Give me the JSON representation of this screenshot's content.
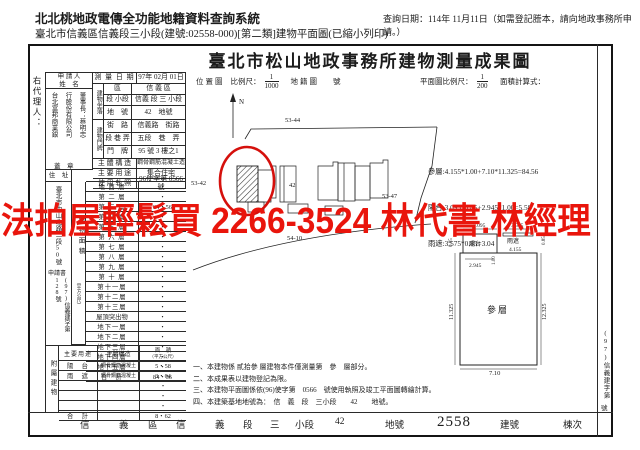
{
  "header": {
    "system_title": "北北桃地政電傳全功能地籍資料查詢系統",
    "query_date": "查詢日期：114年 11月11日（如需登記謄本，請向地政事務所申請。）",
    "doc_line": "臺北市信義區信義段三小段(建號:02558-000)[第二類]建物平面圖(已縮小列印)"
  },
  "title": "臺北市松山地政事務所建物測量成果圖",
  "watermark": "法拍屋輕鬆買 2266-3524 林代書.林經理",
  "margins": {
    "left_agent": "右代理人：",
    "right_doc_no_top": "(97)信義建字第",
    "right_doc_no_bottom": "號"
  },
  "applicant": {
    "label_line1": "申 請 人",
    "label_line2": "姓　名",
    "name_col1": "台北富邦商業銀",
    "name_col2": "行股份有限公司",
    "name_col3": "董事長：蔡明忠",
    "seal": "蓋　章",
    "survey_date_label": "測 量 日 期",
    "survey_date": "97年 02月 01日"
  },
  "situs": {
    "block_label": "建物坐落",
    "rows": [
      {
        "label": "區",
        "value": "信 義 區"
      },
      {
        "label": "段 小段",
        "value": "信義 段 三 小段"
      },
      {
        "label": "地　號",
        "value": "42　地號"
      }
    ]
  },
  "door": {
    "block_label": "建物門牌",
    "rows": [
      {
        "label": "街　路",
        "value": "信義路　街路"
      },
      {
        "label": "段 巷 弄",
        "value": "五段　巷　弄"
      },
      {
        "label": "門　牌",
        "value": "95 號 3 樓之1"
      }
    ]
  },
  "building_info": [
    {
      "label": "主 體 構 造",
      "value": "鋼骨鋼筋混凝土造"
    },
    {
      "label": "主 要 用 途",
      "value": "集合住宅"
    },
    {
      "label": "使 用 執 照",
      "value": "96使字第 0566號"
    }
  ],
  "address": {
    "label": "住　址",
    "value": "臺北市中山北路二段50號",
    "application_label": "申請書",
    "application_no": "(97)信義建字第128號"
  },
  "floor_area": {
    "label": "建物面積",
    "unit": "（平方公尺）",
    "rows": [
      {
        "name": "地 面 層",
        "value": "・"
      },
      {
        "name": "第 二 層",
        "value": "・"
      },
      {
        "name": "第 三 層",
        "value": "84・56"
      },
      {
        "name": "第 四 層",
        "value": "・"
      },
      {
        "name": "第 五 層",
        "value": "・"
      },
      {
        "name": "第 六 層",
        "value": "・"
      },
      {
        "name": "第 七 層",
        "value": "・"
      },
      {
        "name": "第 八 層",
        "value": "・"
      },
      {
        "name": "第 九 層",
        "value": "・"
      },
      {
        "name": "第 十 層",
        "value": "・"
      },
      {
        "name": "第十一層",
        "value": "・"
      },
      {
        "name": "第十二層",
        "value": "・"
      },
      {
        "name": "第十三層",
        "value": "・"
      },
      {
        "name": "屋頂突出物",
        "value": "・"
      },
      {
        "name": "地下一層",
        "value": "・"
      },
      {
        "name": "地下二層",
        "value": "・"
      },
      {
        "name": "地下三層",
        "value": "・"
      },
      {
        "name": "地下四層",
        "value": "・"
      },
      {
        "name": "地下五層",
        "value": "・"
      },
      {
        "name": "合　計",
        "value": "84・56"
      }
    ]
  },
  "annex": {
    "label": "附屬建物",
    "headers": {
      "use": "主要用途",
      "structure": "主體構造",
      "area_line1": "面　積",
      "area_line2": "（平方公尺）"
    },
    "rows": [
      {
        "use": "陽　台",
        "structure": "鋼骨鋼筋混凝土",
        "area": "5・58"
      },
      {
        "use": "雨　遮",
        "structure": "鋼骨鋼筋混凝土",
        "area": "3・04"
      },
      {
        "use": "",
        "structure": "",
        "area": "・"
      },
      {
        "use": "",
        "structure": "",
        "area": "・"
      },
      {
        "use": "",
        "structure": "",
        "area": "・"
      },
      {
        "use": "合　計",
        "structure": "",
        "area": "8・62"
      }
    ]
  },
  "scales": {
    "loc_map_label": "位置圖",
    "scale_label": "比例尺：",
    "loc_num": "1",
    "loc_den": "1000",
    "cadastre_label": "地籍圖",
    "cadastre_no_label": "號",
    "plan_scale_label": "平面圖比例尺：",
    "plan_num": "1",
    "plan_den": "200",
    "calc_label": "面積計算式："
  },
  "calc_lines": [
    "參層:4.155*1.00+7.10*11.325=84.56",
    "陽台:3.095*0.85+2.945*1.00=5.58",
    "雨遮:3.575*0.85=3.04"
  ],
  "map": {
    "north": "N",
    "parcel_53_44": "53-44",
    "parcel_53_42": "53-42",
    "parcel_53_47": "53-47",
    "parcel_54_10": "54-10",
    "subject_no": "42"
  },
  "plan": {
    "room_label": "參層",
    "balcony_label": "陽台",
    "canopy_label": "雨遮",
    "dim_bottom": "7.10",
    "dim_left": "11.325",
    "dim_right": "12.325",
    "dim_balcony_w": "2.945",
    "dim_balcony_top": "3.095",
    "dim_canopy_top": "3.575",
    "dim_canopy_w": "4.155",
    "dim_inner": "1.00",
    "dim_left_small": "0.85",
    "dim_right_small": "0.85"
  },
  "notes": [
    "一、本建物係 貳拾參 層建物本件僅測量第　參　層部分。",
    "二、本成果表以建物登記為限。",
    "三、本建物平面圖係依(96)使字第　0566　號使用執照及竣工平面圖轉繪計算。",
    "四、本建築基地地號為：　信　義　段　三小段　　42　　地號。"
  ],
  "footer": {
    "district": "信　義",
    "district_suffix": "區",
    "section": "信　義",
    "section_suffix": "段",
    "subsection": "三",
    "subsection_suffix": "小段",
    "land_no": "42",
    "land_suffix": "地號",
    "building_no": "2558",
    "building_suffix": "建號",
    "unit_suffix": "棟次"
  }
}
